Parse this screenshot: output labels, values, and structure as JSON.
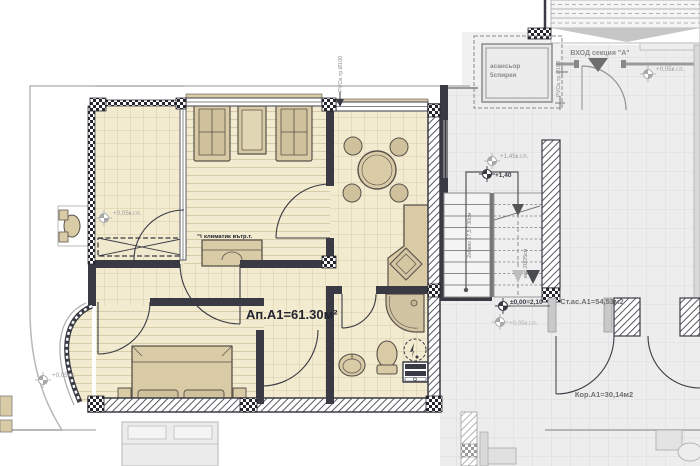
{
  "colors": {
    "floor_apartment": "#f2ebcf",
    "floor_grid_line": "#d7cda8",
    "floor_common": "#ededed",
    "wall_dark": "#3a3a44",
    "furniture_tan": "#d8cba6",
    "label_dark": "#23232e",
    "label_gray": "#8f8f8f"
  },
  "apartment": {
    "area_label": "Ап.А1=61.30м²",
    "ac_unit_label": "климатик вътр.т."
  },
  "common_areas": {
    "entrance_label": "ВХОД секция \"А\"",
    "staircase_area_label": "Ст.ас.А1=54,53м2",
    "corridor_area_label": "Кор.А1=30,14м2",
    "elevator_label_line1": "асансьор",
    "elevator_label_line2": "5спирки",
    "stairs_left_flight_label": "2х8вис 17,5 / 30см",
    "stairs_right_flight_label": "вис.20/25см",
    "riser_pipe_label": "PVCв.тр.Ø100"
  },
  "level_markers": [
    {
      "location": "terrace-top-left",
      "text": "+0,05к.г.п."
    },
    {
      "location": "balcony-bottom-left",
      "text": "+0,05к.г."
    },
    {
      "location": "entrance",
      "text": "+0,05к.г.п."
    },
    {
      "location": "stair-landing-upper",
      "text": "+1,45к.г.п."
    },
    {
      "location": "stair-landing-bold",
      "text": "+1,40"
    },
    {
      "location": "stair-bottom-bold",
      "text": "±0,00=2,10"
    },
    {
      "location": "stair-bottom",
      "text": "+0,05к.г.п."
    }
  ]
}
